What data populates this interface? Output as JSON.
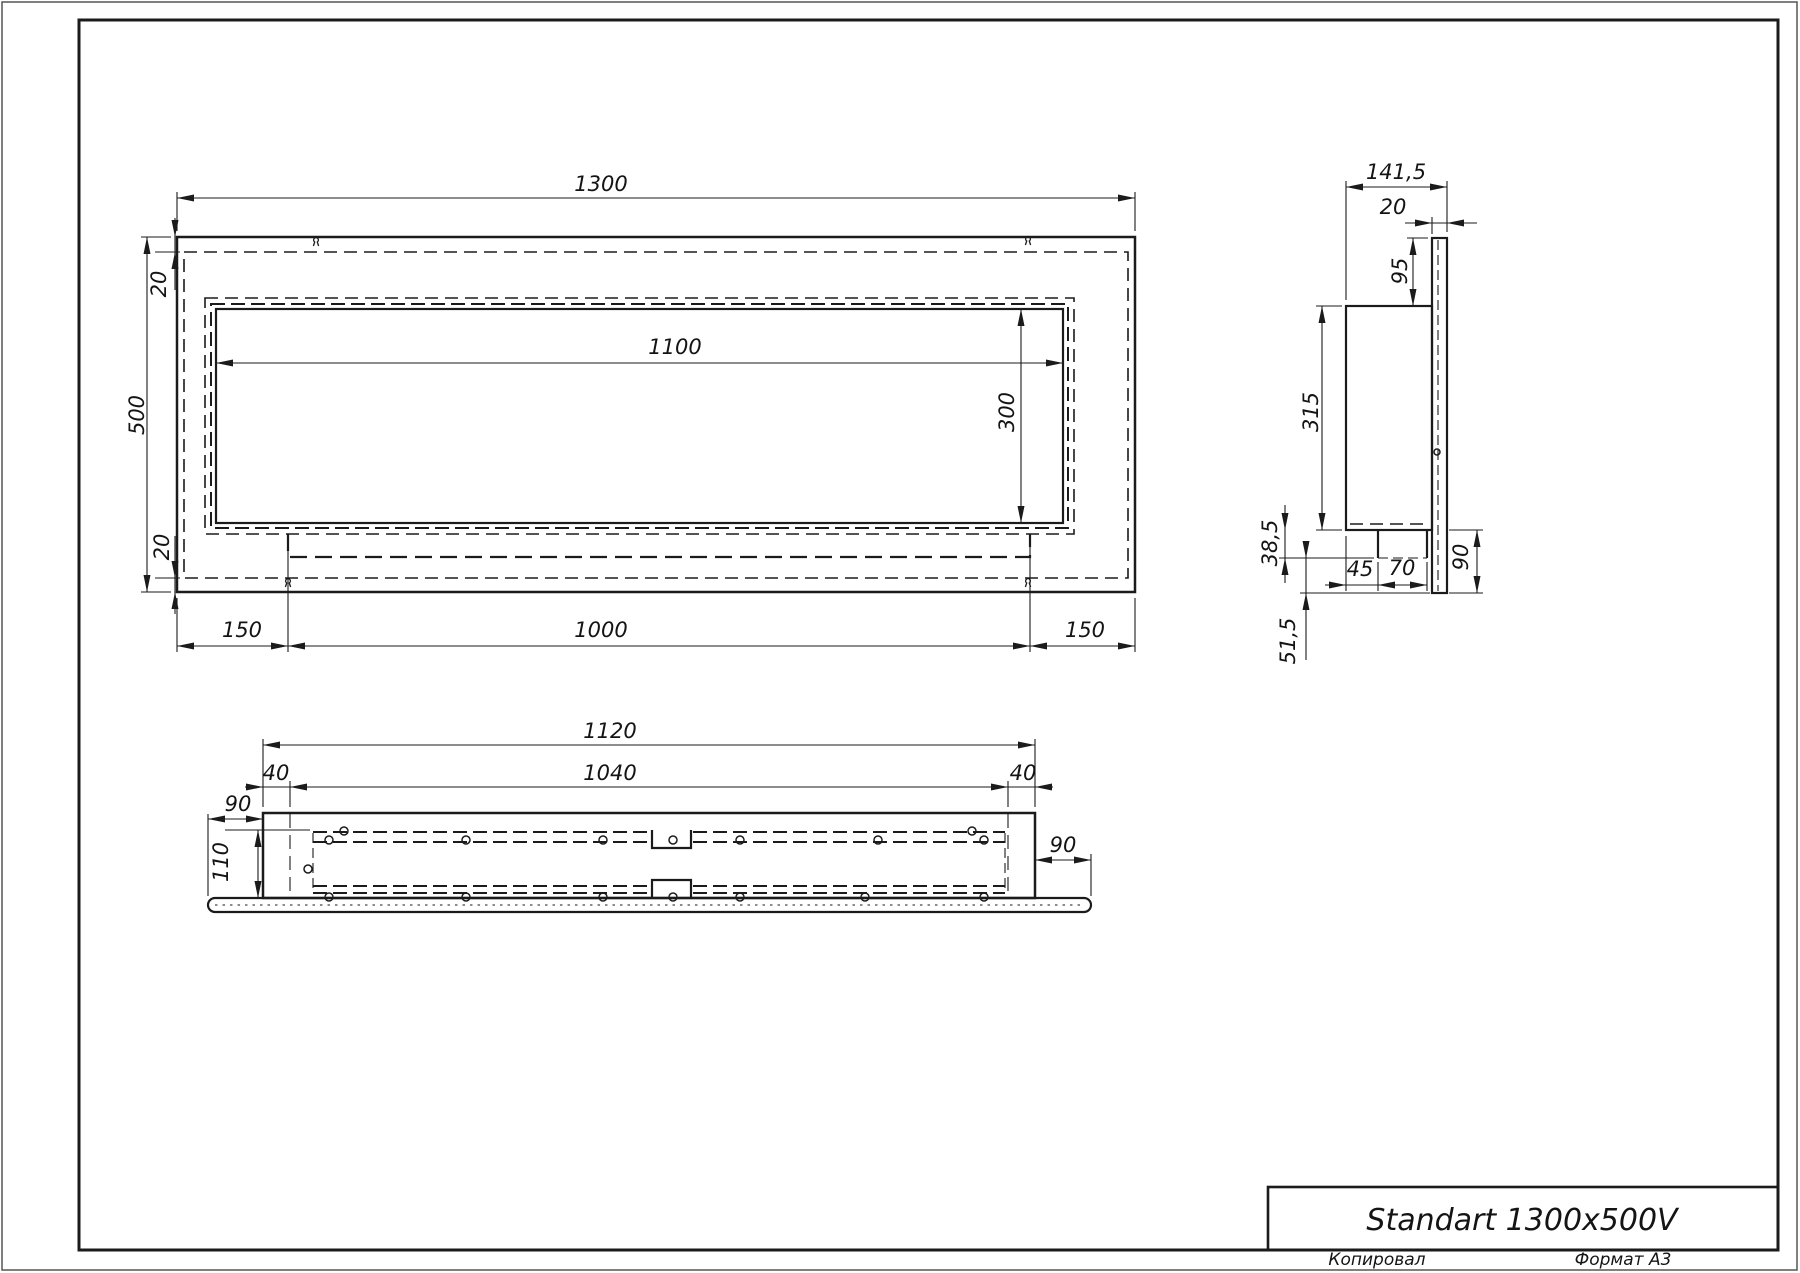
{
  "title_block": {
    "title": "Standart 1300x500V",
    "footer_left": "Копировал",
    "footer_right": "Формат А3"
  },
  "front": {
    "width": "1300",
    "height": "500",
    "top_inset": "20",
    "bottom_inset": "20",
    "opening_width": "1100",
    "opening_height": "300",
    "left_margin": "150",
    "burner_width": "1000",
    "right_margin": "150"
  },
  "side": {
    "depth": "141,5",
    "flange_thickness": "20",
    "top_drop": "95",
    "body_height": "315",
    "tank_inset": "45",
    "tank_width": "70",
    "tank_drop": "38,5",
    "spout_drop": "51,5",
    "bottom_drop": "90"
  },
  "plan": {
    "body_width": "1120",
    "burner_width": "1040",
    "left_inset": "40",
    "right_inset": "40",
    "left_overhang": "90",
    "right_overhang": "90",
    "body_depth": "110"
  },
  "colors": {
    "line": "#1b1b1b",
    "background": "#ffffff"
  }
}
